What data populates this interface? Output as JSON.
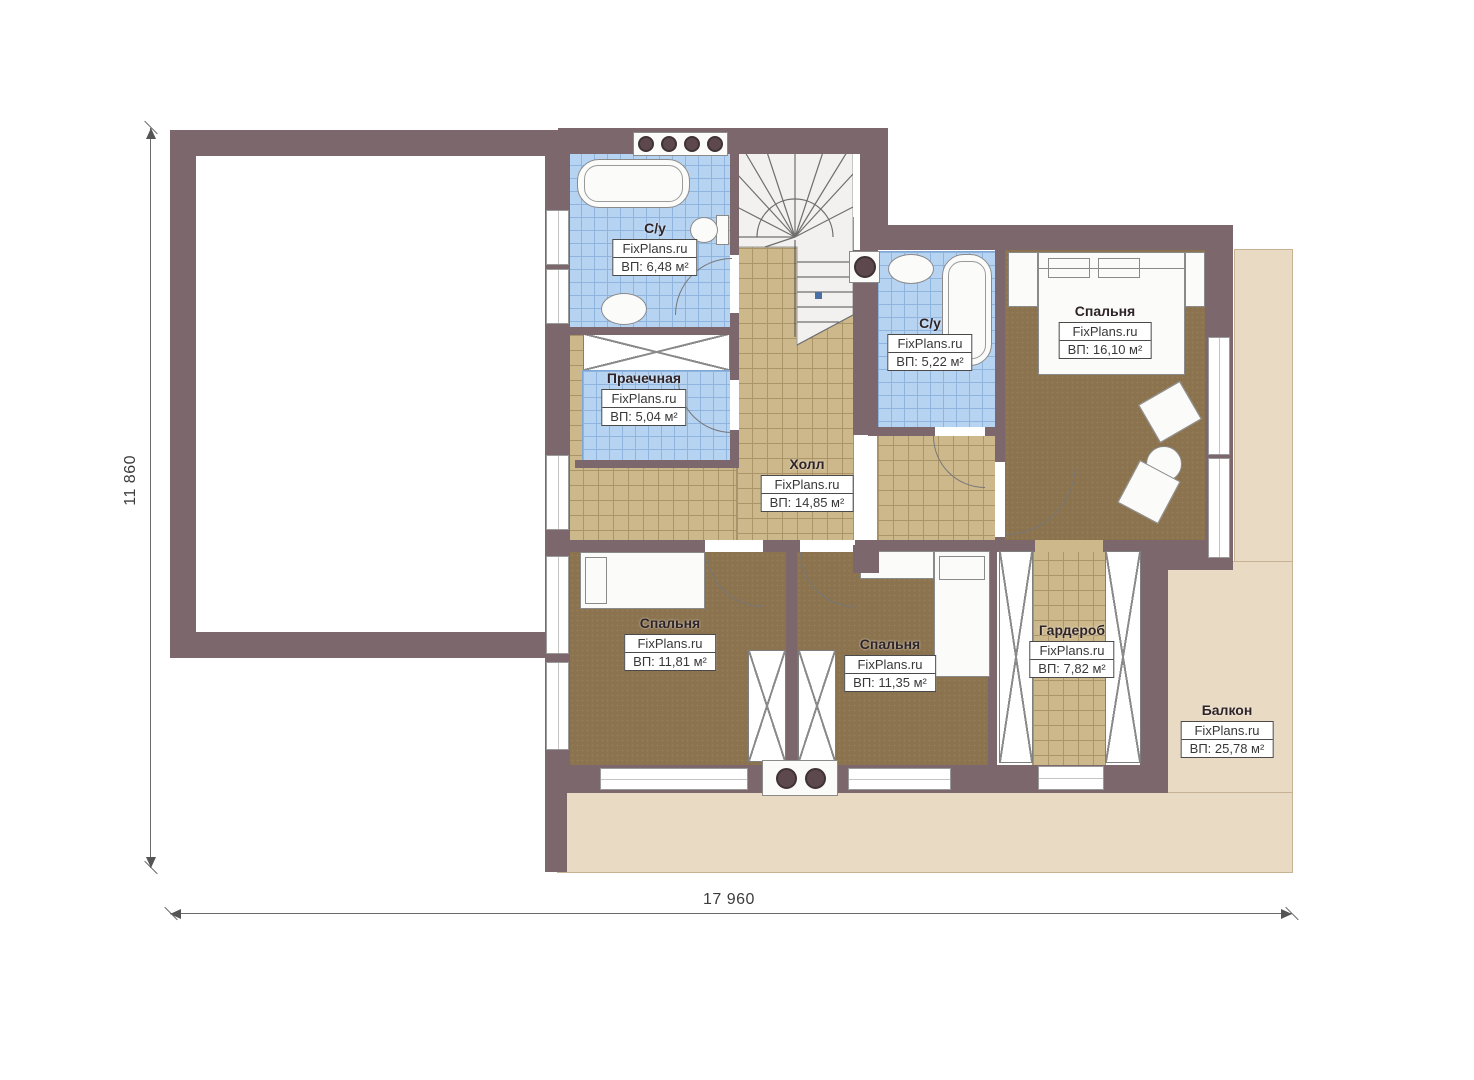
{
  "plan": {
    "brand": "FixPlans.ru",
    "rooms": [
      {
        "name": "С/у",
        "area": "ВП: 6,48 м²"
      },
      {
        "name": "С/у",
        "area": "ВП: 5,22 м²"
      },
      {
        "name": "Прачечная",
        "area": "ВП: 5,04 м²"
      },
      {
        "name": "Холл",
        "area": "ВП: 14,85 м²"
      },
      {
        "name": "Спальня",
        "area": "ВП: 16,10 м²"
      },
      {
        "name": "Спальня",
        "area": "ВП: 11,81 м²"
      },
      {
        "name": "Спальня",
        "area": "ВП: 11,35 м²"
      },
      {
        "name": "Гардероб",
        "area": "ВП: 7,82 м²"
      },
      {
        "name": "Балкон",
        "area": "ВП: 25,78 м²"
      }
    ],
    "dimensions": {
      "height_label": "11 860",
      "width_label": "17 960"
    },
    "colors": {
      "wall": "#7c686c",
      "tile_blue": "#b7d3f2",
      "tile_tan": "#cdb88b",
      "carpet": "#8b734f",
      "balcony": "#e9dac3"
    }
  }
}
